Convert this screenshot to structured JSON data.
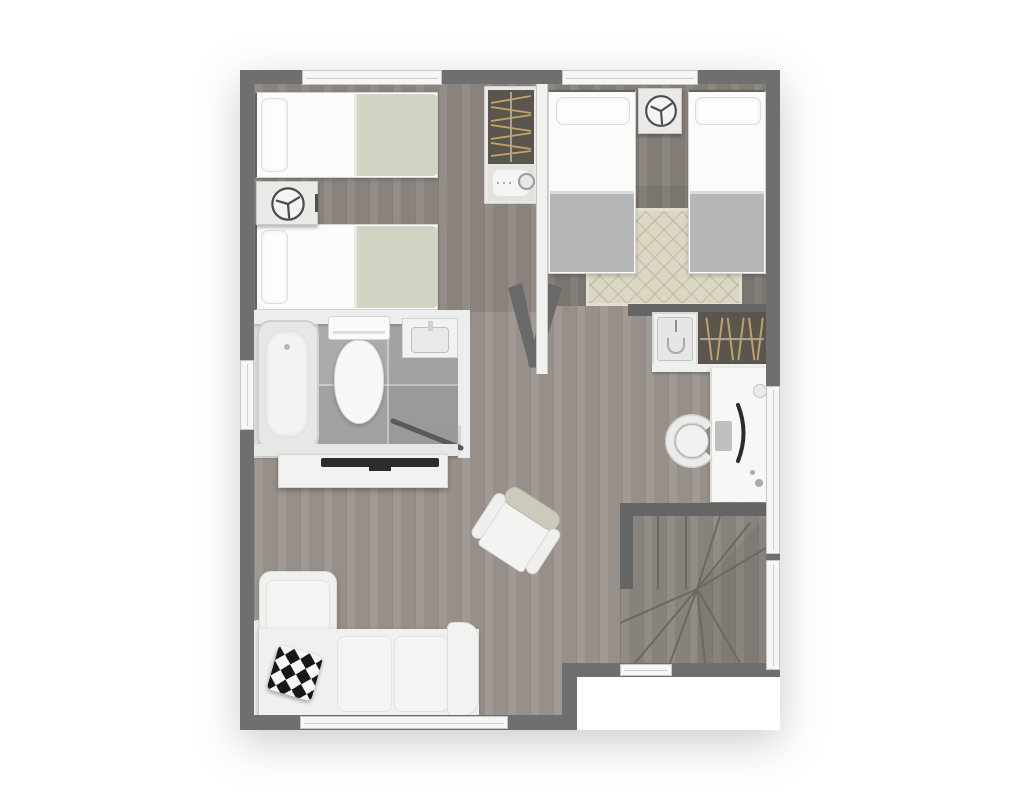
{
  "title": "Apartment upper-floor plan (top-down 3D render)",
  "colors": {
    "wall": "#6f6f6f",
    "wall_dark": "#656565",
    "interior_wall": "#f1f1ef",
    "window_fill": "#f6f6f5",
    "window_frame": "#c6c6c5",
    "floor_living": "#9c958e",
    "floor_bedroom1": "#8e8781",
    "floor_bedroom2": "#87817a",
    "floor_stairs": "#8b8680",
    "tile": "#ababa9",
    "bath_wall": "#eceded",
    "white_furniture": "#f2f2f0",
    "furniture_border": "#d7d7d5",
    "blanket_sage": "#d3d3c3",
    "blanket_gray": "#b6b6b8",
    "rug": "#dcd7c5",
    "closet_dark": "#5a564e",
    "hanger_gold": "#c3a268",
    "sofa": "#f0f0ee",
    "tv_dark": "#2c2c2c",
    "chair_back_tan": "#cdc9bb",
    "stair_line": "#6c6862",
    "icon_stroke": "#4c4c4c"
  },
  "rooms": {
    "bedroom_left": {
      "label": "Bedroom 1",
      "furniture": [
        "single-bed",
        "single-bed",
        "nightstand-with-fan",
        "wardrobe-with-hangers",
        "cabinet"
      ]
    },
    "bedroom_right": {
      "label": "Bedroom 2",
      "furniture": [
        "single-bed",
        "single-bed",
        "nightstand-with-fan",
        "patterned-rug"
      ]
    },
    "bathroom": {
      "label": "Bathroom",
      "furniture": [
        "bathtub",
        "toilet",
        "washbasin",
        "door-swing"
      ]
    },
    "living_hall": {
      "label": "Living / Hall",
      "furniture": [
        "sectional-sofa",
        "throw-pillow",
        "tv-console",
        "flat-tv",
        "armchair",
        "double-door"
      ]
    },
    "study_nook": {
      "label": "Study nook",
      "furniture": [
        "desk",
        "monitor",
        "keyboard",
        "desk-chair",
        "wardrobe-with-hangers",
        "utility-basin"
      ]
    },
    "staircase": {
      "label": "Winder staircase",
      "furniture": [
        "stair-treads"
      ]
    }
  },
  "windows": {
    "count": 7,
    "locations": [
      "top-left bedroom",
      "top-right bedroom",
      "left wall at bathroom",
      "bottom wall at sofa",
      "right wall at desk",
      "right wall at stairs",
      "bottom wall at stairs"
    ]
  }
}
